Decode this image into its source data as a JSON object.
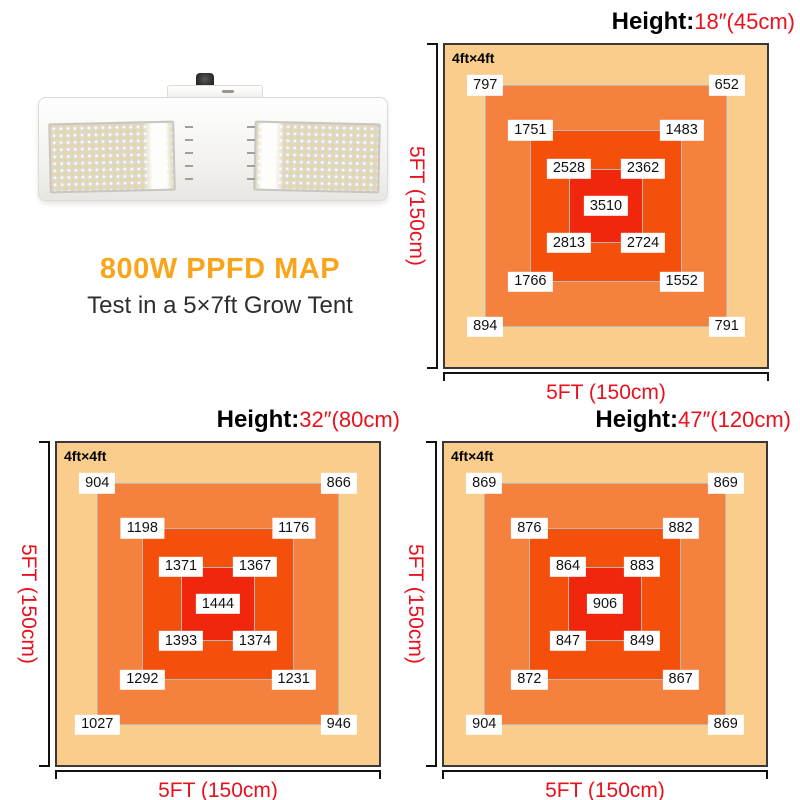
{
  "product": {
    "title": "800W PPFD MAP",
    "subtitle": "Test in a 5×7ft Grow Tent",
    "image": "white-double-panel-led-grow-light"
  },
  "colors": {
    "title_orange": "#F9A51B",
    "axis_red": "#E8121E",
    "zone_outer": "#FACD8D",
    "zone_mid": "#F5813F",
    "zone_inner": "#F4500C",
    "zone_center": "#F1270D",
    "label_bg": "#FFFFFF",
    "label_text": "#111111",
    "ring_border": "#BDB6AD",
    "map_border": "#383838",
    "bracket": "#111111"
  },
  "axis": {
    "height_prefix": "Height:",
    "x_label": "5FT (150cm)",
    "y_label": "5FT (150cm)",
    "area_label": "4ft×4ft"
  },
  "maps": [
    {
      "height_value": "18″(45cm)",
      "center": "3510",
      "ring3": {
        "tl": "2528",
        "tr": "2362",
        "bl": "2813",
        "br": "2724"
      },
      "ring2": {
        "tl": "1751",
        "tr": "1483",
        "bl": "1766",
        "br": "1552"
      },
      "ring1": {
        "tl": "797",
        "tr": "652",
        "bl": "894",
        "br": "791"
      }
    },
    {
      "height_value": "32″(80cm)",
      "center": "1444",
      "ring3": {
        "tl": "1371",
        "tr": "1367",
        "bl": "1393",
        "br": "1374"
      },
      "ring2": {
        "tl": "1198",
        "tr": "1176",
        "bl": "1292",
        "br": "1231"
      },
      "ring1": {
        "tl": "904",
        "tr": "866",
        "bl": "1027",
        "br": "946"
      }
    },
    {
      "height_value": "47″(120cm)",
      "center": "906",
      "ring3": {
        "tl": "864",
        "tr": "883",
        "bl": "847",
        "br": "849"
      },
      "ring2": {
        "tl": "876",
        "tr": "882",
        "bl": "872",
        "br": "867"
      },
      "ring1": {
        "tl": "869",
        "tr": "869",
        "bl": "904",
        "br": "869"
      }
    }
  ],
  "chart_data": [
    {
      "type": "heatmap",
      "title": "Height: 18″(45cm)",
      "area": "4ft×4ft",
      "footprint": "5FT (150cm) × 5FT (150cm)",
      "center_value": 3510,
      "zones": [
        {
          "zone": "center",
          "values": [
            3510
          ]
        },
        {
          "zone": "inner-ring corners (TL,TR,BL,BR)",
          "values": [
            2528,
            2362,
            2813,
            2724
          ]
        },
        {
          "zone": "middle-ring corners (TL,TR,BL,BR)",
          "values": [
            1751,
            1483,
            1766,
            1552
          ]
        },
        {
          "zone": "outer-ring corners (TL,TR,BL,BR)",
          "values": [
            797,
            652,
            894,
            791
          ]
        }
      ]
    },
    {
      "type": "heatmap",
      "title": "Height: 32″(80cm)",
      "area": "4ft×4ft",
      "footprint": "5FT (150cm) × 5FT (150cm)",
      "center_value": 1444,
      "zones": [
        {
          "zone": "center",
          "values": [
            1444
          ]
        },
        {
          "zone": "inner-ring corners (TL,TR,BL,BR)",
          "values": [
            1371,
            1367,
            1393,
            1374
          ]
        },
        {
          "zone": "middle-ring corners (TL,TR,BL,BR)",
          "values": [
            1198,
            1176,
            1292,
            1231
          ]
        },
        {
          "zone": "outer-ring corners (TL,TR,BL,BR)",
          "values": [
            904,
            866,
            1027,
            946
          ]
        }
      ]
    },
    {
      "type": "heatmap",
      "title": "Height: 47″(120cm)",
      "area": "4ft×4ft",
      "footprint": "5FT (150cm) × 5FT (150cm)",
      "center_value": 906,
      "zones": [
        {
          "zone": "center",
          "values": [
            906
          ]
        },
        {
          "zone": "inner-ring corners (TL,TR,BL,BR)",
          "values": [
            864,
            883,
            847,
            849
          ]
        },
        {
          "zone": "middle-ring corners (TL,TR,BL,BR)",
          "values": [
            876,
            882,
            872,
            867
          ]
        },
        {
          "zone": "outer-ring corners (TL,TR,BL,BR)",
          "values": [
            869,
            869,
            904,
            869
          ]
        }
      ]
    }
  ]
}
